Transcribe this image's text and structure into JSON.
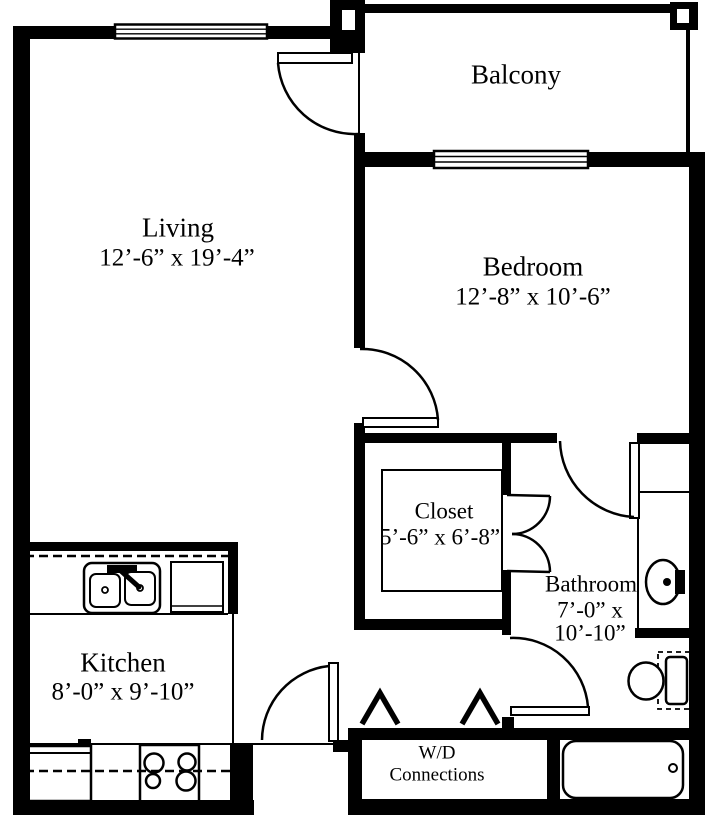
{
  "floorplan": {
    "rooms": {
      "living": {
        "label": "Living",
        "dims": "12’-6” x 19’-4”"
      },
      "bedroom": {
        "label": "Bedroom",
        "dims": "12’-8” x 10’-6”"
      },
      "balcony": {
        "label": "Balcony"
      },
      "closet": {
        "label": "Closet",
        "dims": "5’-6” x 6’-8”"
      },
      "bathroom": {
        "label": "Bathroom",
        "dims_line1": "7’-0” x",
        "dims_line2": "10’-10”"
      },
      "kitchen": {
        "label": "Kitchen",
        "dims": "8’-0” x 9’-10”"
      },
      "laundry": {
        "label_line1": "W/D",
        "label_line2": "Connections"
      }
    },
    "colors": {
      "wall": "#000000",
      "background": "#ffffff",
      "text": "#000000"
    }
  }
}
